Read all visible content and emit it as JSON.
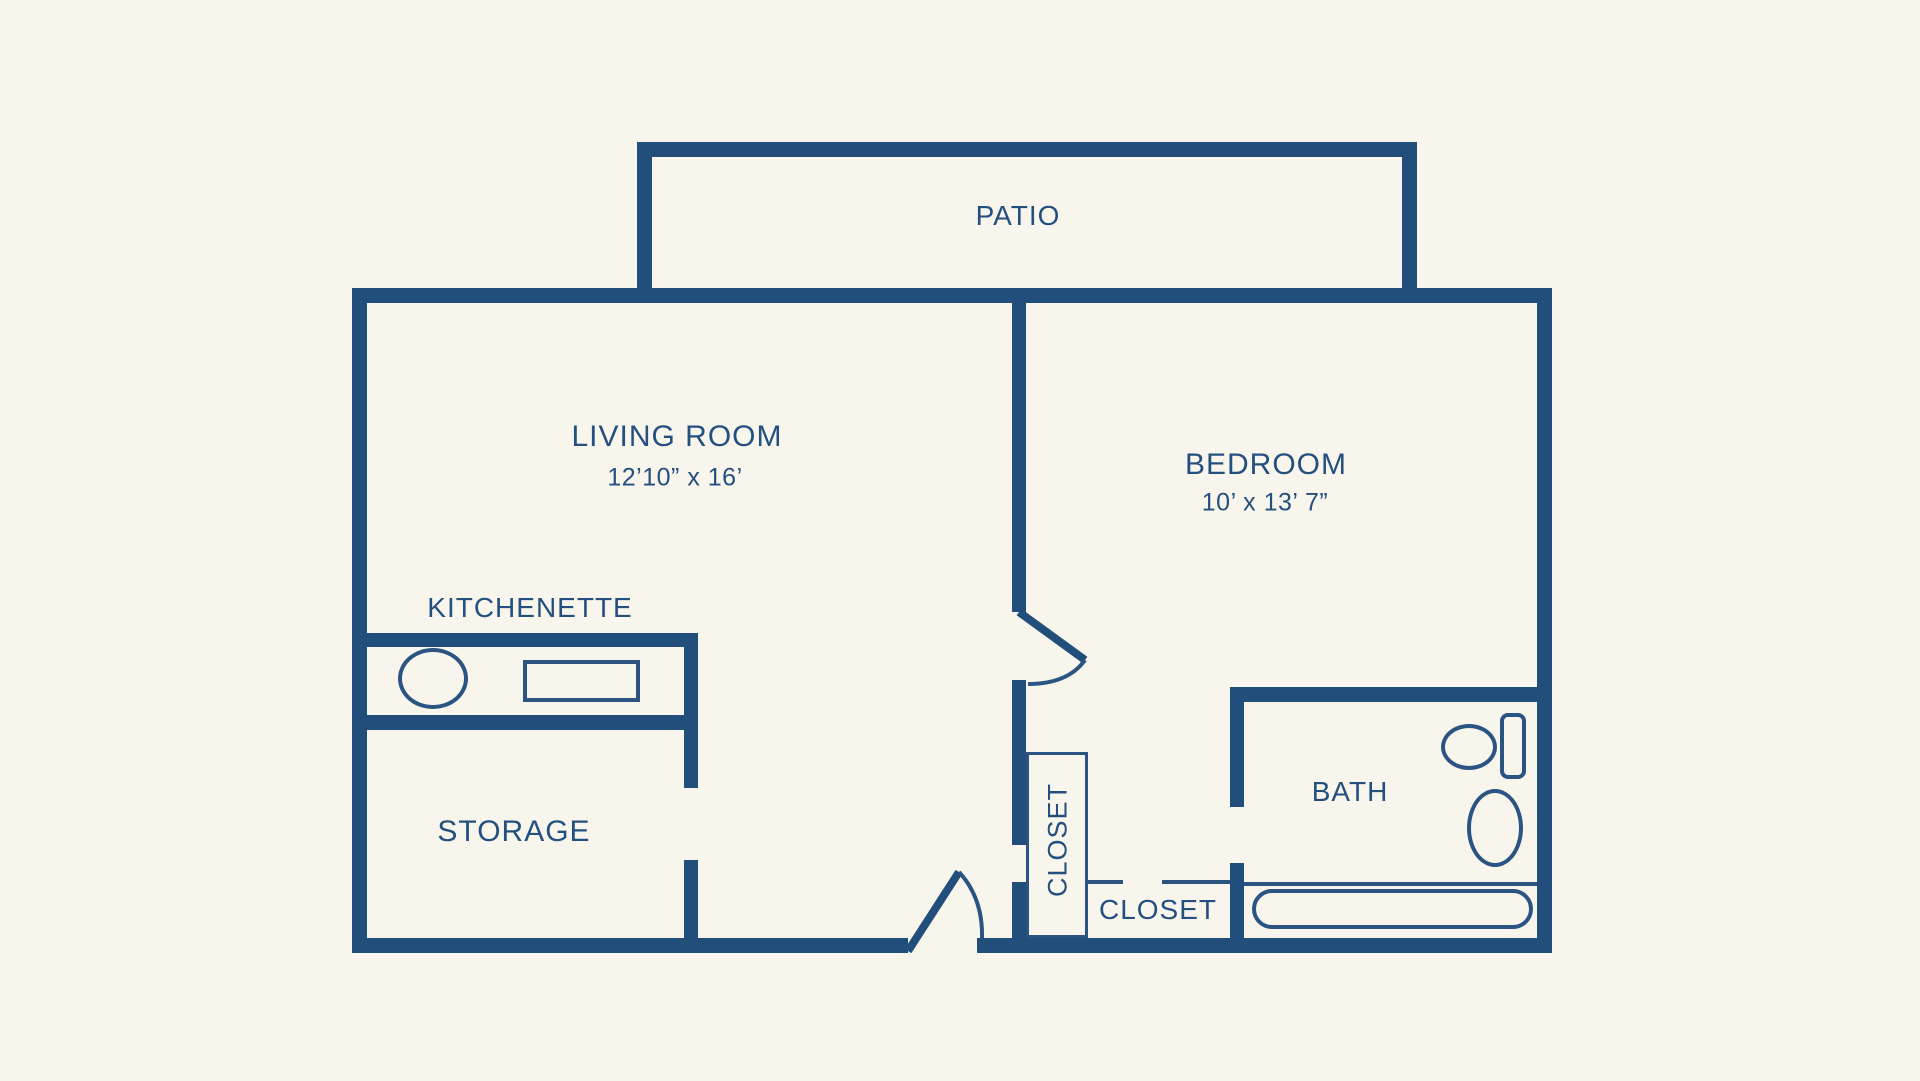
{
  "diagram": {
    "type": "floor-plan",
    "colors": {
      "wall": "#224e7c",
      "text": "#24507f",
      "background": "#f8f5ed"
    },
    "rooms": {
      "patio": {
        "label": "PATIO"
      },
      "living_room": {
        "label": "LIVING ROOM",
        "dimensions": "12’10” x 16’"
      },
      "bedroom": {
        "label": "BEDROOM",
        "dimensions": "10’ x 13’ 7”"
      },
      "kitchenette": {
        "label": "KITCHENETTE"
      },
      "storage": {
        "label": "STORAGE"
      },
      "closet_hall": {
        "label": "CLOSET"
      },
      "closet_entry": {
        "label": "CLOSET"
      },
      "bath": {
        "label": "BATH"
      }
    },
    "fixtures": [
      "kitchen-sink",
      "kitchen-appliance",
      "toilet-bowl",
      "toilet-tank",
      "bathroom-sink",
      "bathtub"
    ],
    "doors": [
      "entry-door",
      "bedroom-door"
    ]
  }
}
